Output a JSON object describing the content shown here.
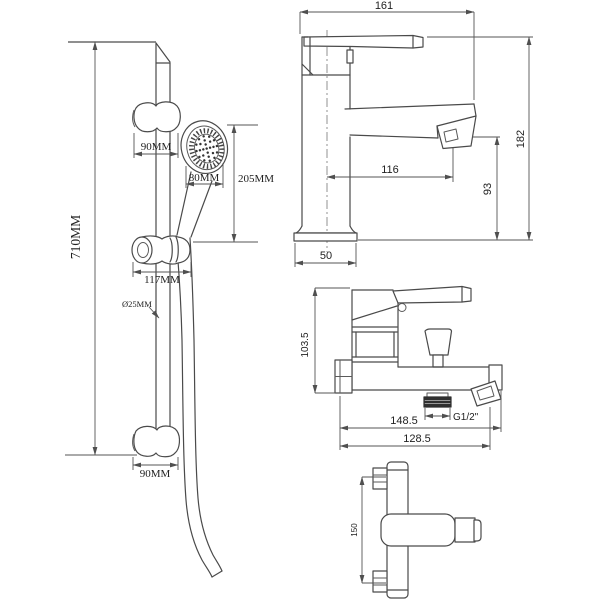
{
  "colors": {
    "background": "#ffffff",
    "line": "#4a4a4a",
    "dimension_line": "#555555",
    "text": "#222222",
    "thread_fill": "#2f2f2f"
  },
  "shower_rail_view": {
    "rail_length": "710MM",
    "top_bracket_width": "90MM",
    "head_face_diameter": "80MM",
    "head_assembly_length": "205MM",
    "holder_width": "117MM",
    "rail_diameter": "Ø25MM",
    "bottom_bracket_width": "90MM"
  },
  "basin_mixer_view": {
    "overall_width": "161",
    "overall_height": "182",
    "spout_reach": "116",
    "spout_height": "93",
    "base_width": "50"
  },
  "bath_mixer_front_view": {
    "body_height": "103.5",
    "overall_length": "148.5",
    "length_to_outlet": "128.5",
    "outlet_thread": "G1/2\""
  },
  "bath_mixer_top_view": {
    "connector_spacing": "150"
  }
}
